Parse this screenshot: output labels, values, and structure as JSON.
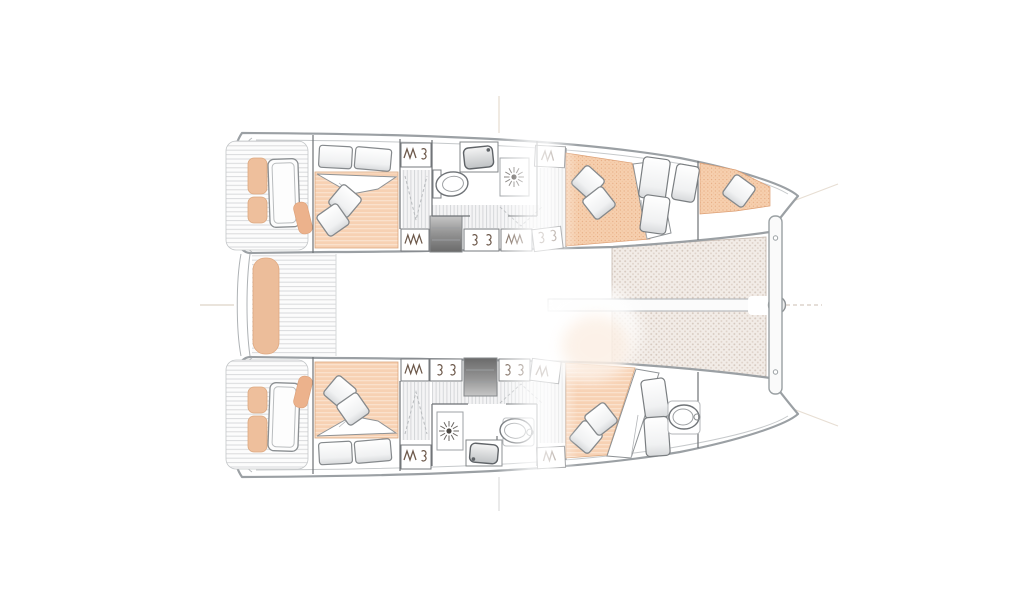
{
  "document": {
    "title": "Catamaran interior layout plan, top view, bow to the right",
    "canvas": {
      "width": 1024,
      "height": 600,
      "background": "#ffffff"
    }
  },
  "drawing": {
    "type": "yacht-floorplan-top-view",
    "vessel": "catamaran",
    "orientation": "bow-right",
    "colors": {
      "hull_outline": "#9ba0a4",
      "toe_rail": "#c6c9cb",
      "interior_wall": "#6e7276",
      "furniture_line": "#7c8084",
      "deck_plank_line": "#d9dadc",
      "corridor_stripe": "#d2d4d6",
      "mattress_fill": "#f6cfae",
      "mattress_texture": "#e8ab81",
      "cushion_fill": "#ecbd9a",
      "cushion_accent": "#ecb28c",
      "trampoline_fill": "#f2ece7",
      "trampoline_dot": "#d5c8be",
      "steps_dark": "#6a6a6a",
      "symbol_ink": "#6d594b",
      "register_mark": "#ddd3c7"
    },
    "features": {
      "hull_count": 2,
      "bathroom_count": 2,
      "cabins": [
        {
          "name": "top-hull-aft-cabin",
          "berth": "double-bed"
        },
        {
          "name": "top-hull-forward-cabin",
          "berth": "double-bed"
        },
        {
          "name": "top-hull-forepeak",
          "berth": "single-berth"
        },
        {
          "name": "bottom-hull-aft-cabin",
          "berth": "double-bed"
        },
        {
          "name": "bottom-hull-forward-cabin",
          "berth": "double-bed"
        },
        {
          "name": "bottom-hull-forepeak",
          "fixture": "toilet"
        }
      ],
      "fixture_icons": [
        "toilet-icon",
        "sink-icon",
        "shower-head-icon",
        "hanging-locker-icon",
        "shelf-hooks-icon",
        "companionway-steps",
        "trampoline-mesh",
        "bow-crossbeam",
        "bowsprit-fitting",
        "cockpit-bench",
        "transom-hatch",
        "helm-seat-cushion",
        "bed-pillow",
        "duvet"
      ]
    }
  }
}
